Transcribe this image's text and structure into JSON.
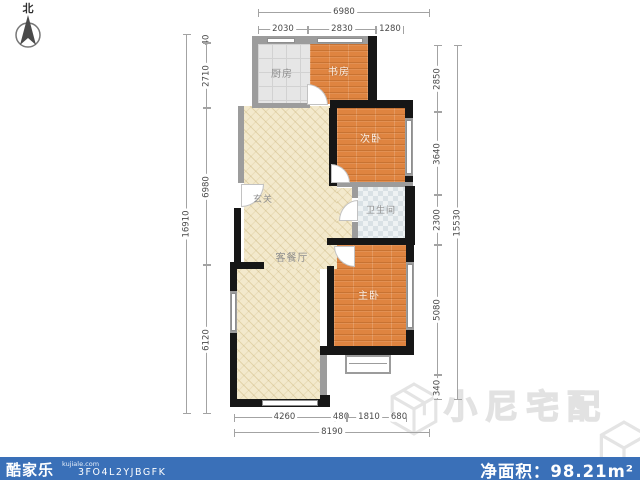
{
  "compass": {
    "label": "北"
  },
  "plan": {
    "rooms": {
      "kitchen": "厨房",
      "study": "书房",
      "second_bedroom": "次卧",
      "bathroom": "卫生间",
      "master_bedroom": "主卧",
      "entrance": "玄关",
      "living_dining": "客餐厅"
    },
    "dimensions": {
      "top": {
        "overall": "6980",
        "segments": [
          "2030",
          "2830",
          "1280"
        ]
      },
      "left": {
        "overall": "16910",
        "segments": [
          "40",
          "2710",
          "6980",
          "6120"
        ]
      },
      "right": {
        "overall": "15530",
        "segments": [
          "2850",
          "3640",
          "2300",
          "5080",
          "340"
        ]
      },
      "bottom": {
        "overall": "8190",
        "segments": [
          "4260",
          "480",
          "1810",
          "680"
        ]
      }
    }
  },
  "watermark": {
    "text": "小尼宅配"
  },
  "footer": {
    "brand": "酷家乐",
    "site": "kujiale.com",
    "code": "3FO4L2YJBGFK",
    "area_label": "净面积：",
    "area_value": "98.21m²"
  },
  "colors": {
    "footer_bar": "#3a70b8",
    "wood_floor": "#df8440",
    "living_floor": "#f3e9cc",
    "wall_dark": "#161616",
    "wall_light": "#9c9c9c"
  }
}
